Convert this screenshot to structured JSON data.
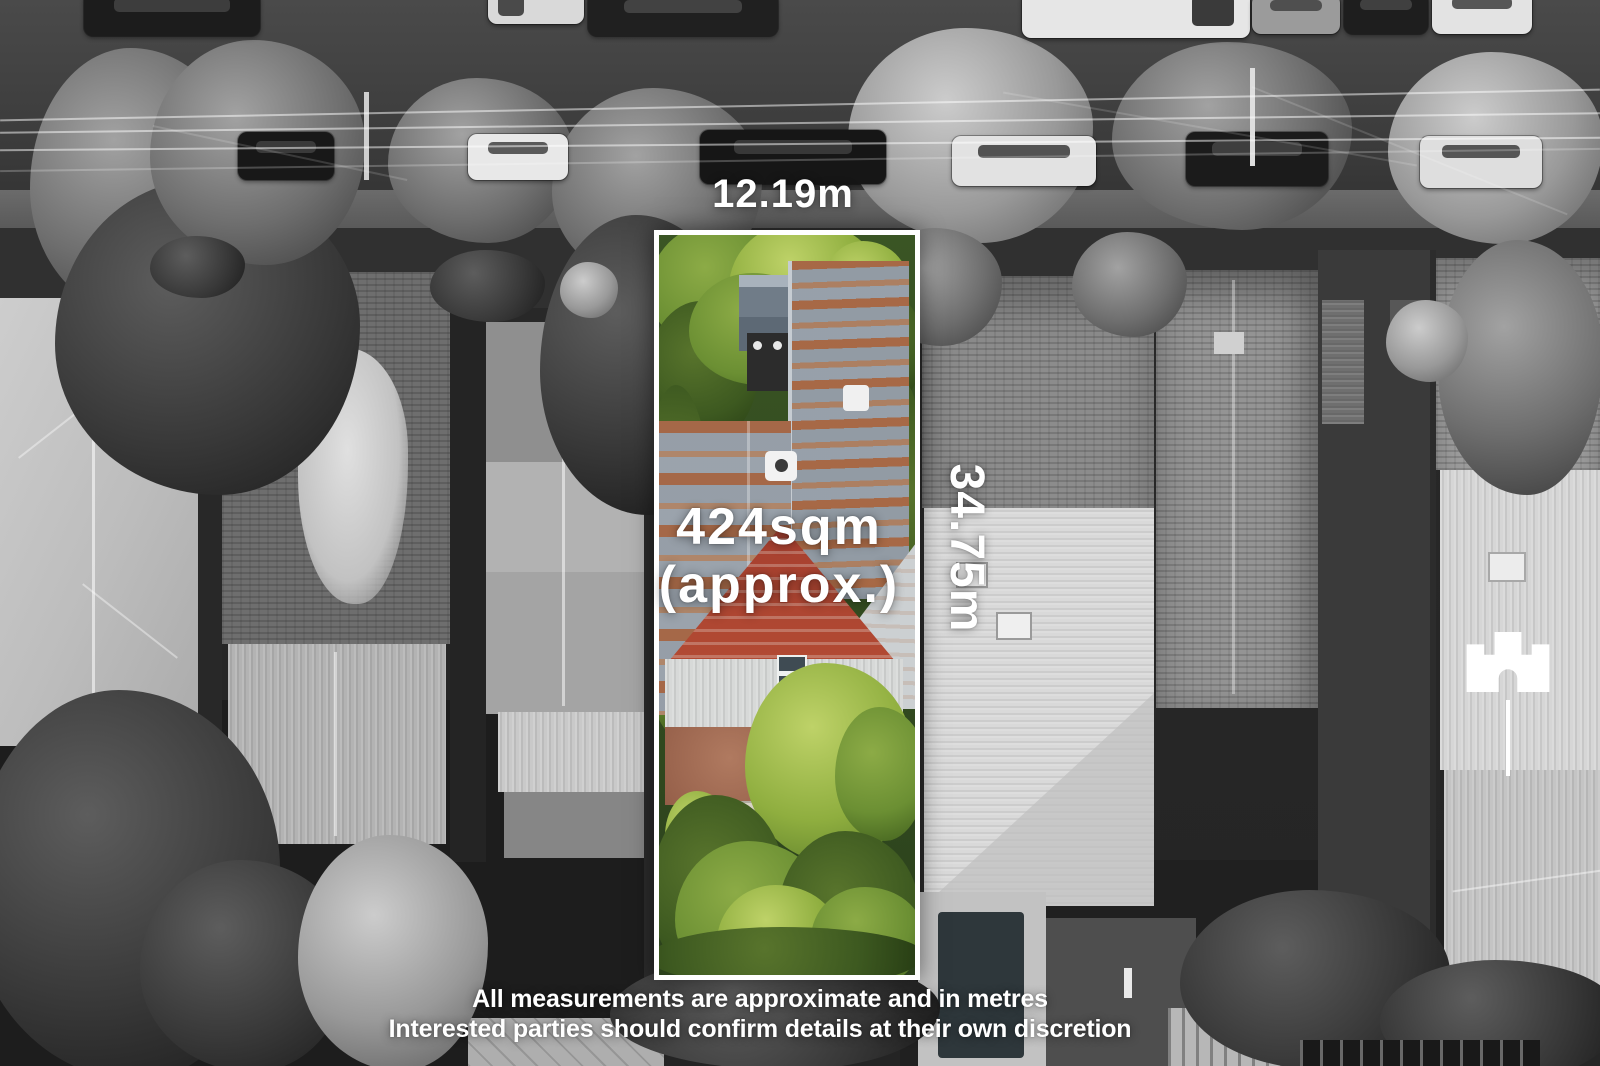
{
  "overlay": {
    "frontage_label": "12.19m",
    "depth_label": "34.75m",
    "area_label": "424sqm",
    "area_qualifier": "(approx.)",
    "disclaimer_line1": "All measurements are approximate and in metres",
    "disclaimer_line2": "Interested parties should confirm details at their own discretion"
  },
  "branding": {
    "logo_icon": "castle-icon"
  },
  "colors": {
    "overlay_text": "#ffffff",
    "boundary_border": "#ffffff",
    "foliage_green": "#7fa348",
    "rust_roof": "#a8613c",
    "red_gable": "#ad4331",
    "road_asphalt": "#414141"
  }
}
